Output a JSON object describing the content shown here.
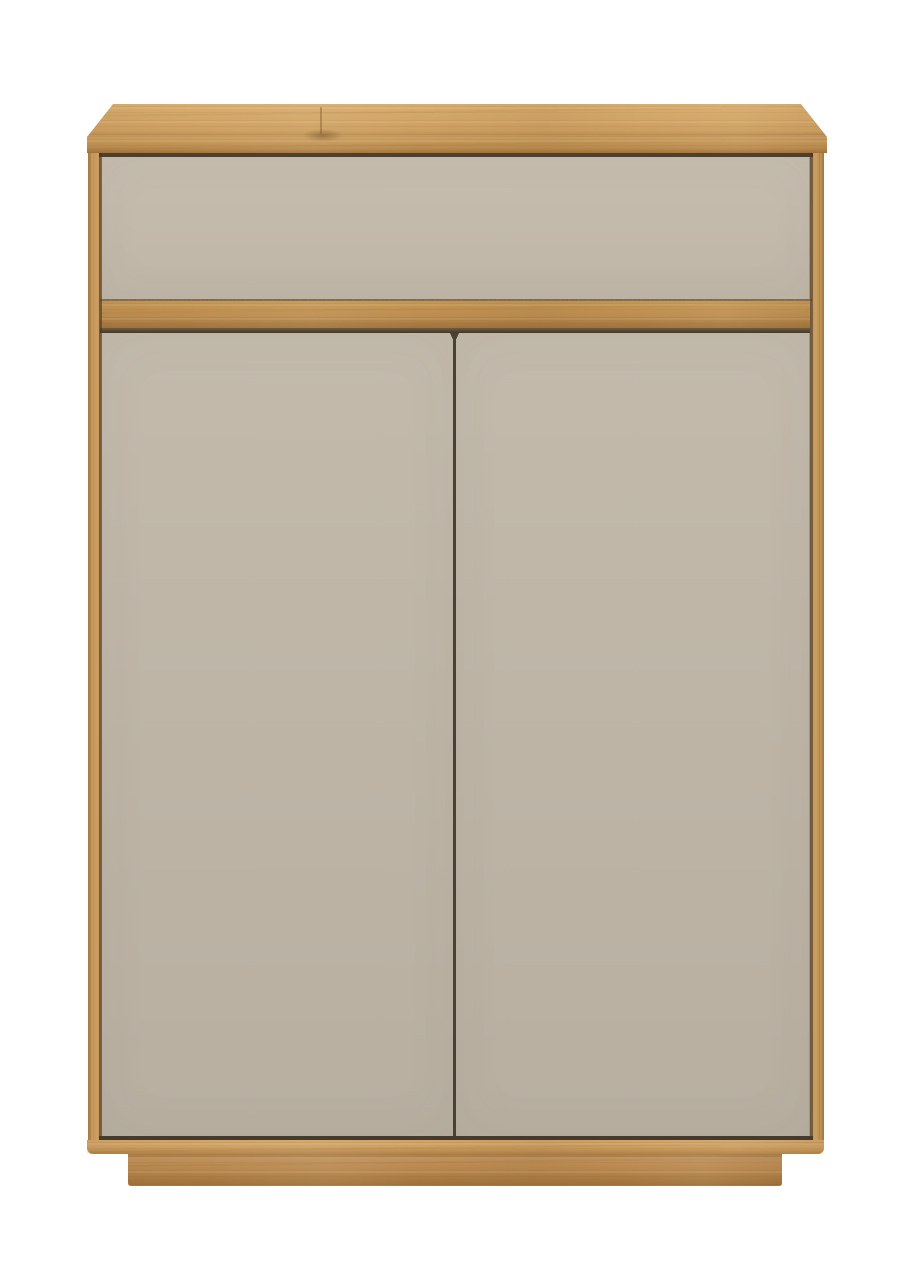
{
  "scene": {
    "type": "product-photo",
    "subject": "Oak cabinet with one grey-beige drawer front and two grey-beige doors on a recessed oak plinth",
    "background": "#ffffff"
  },
  "palette": {
    "background": "#ffffff",
    "oak-top-light": "#d8ad6d",
    "oak-top": "#cd9f61",
    "oak-top-dark": "#ba8b4e",
    "oak-rail-light": "#c59755",
    "oak-rail": "#bd8d50",
    "oak-rail-dark": "#a0733c",
    "oak-stile": "#c09155",
    "oak-stile-light": "#cc9f61",
    "oak-stile-dark": "#a37841",
    "oak-base-light": "#d2a566",
    "oak-base": "#cb9d60",
    "oak-base-dark": "#b08247",
    "oak-plinth": "#c09058",
    "oak-plinth-light": "#b5854c",
    "oak-plinth-dark": "#9d7038",
    "oak-plinth-shadow": "#a87c48",
    "panel-drawer": "#c6bdaf",
    "panel-drawer-dark": "#bfb6a8",
    "panel-door": "#c3baac",
    "panel-door-dark": "#b8afa1",
    "seam": "#4a4132"
  },
  "parts": [
    {
      "id": "top-panel",
      "label": "oak top panel"
    },
    {
      "id": "drawer-front",
      "label": "drawer front"
    },
    {
      "id": "middle-rail",
      "label": "oak middle rail"
    },
    {
      "id": "left-door",
      "label": "left door"
    },
    {
      "id": "right-door",
      "label": "right door"
    },
    {
      "id": "side-frame",
      "label": "oak side frame"
    },
    {
      "id": "bottom-rail",
      "label": "oak bottom rail"
    },
    {
      "id": "plinth-base",
      "label": "recessed oak plinth"
    }
  ]
}
